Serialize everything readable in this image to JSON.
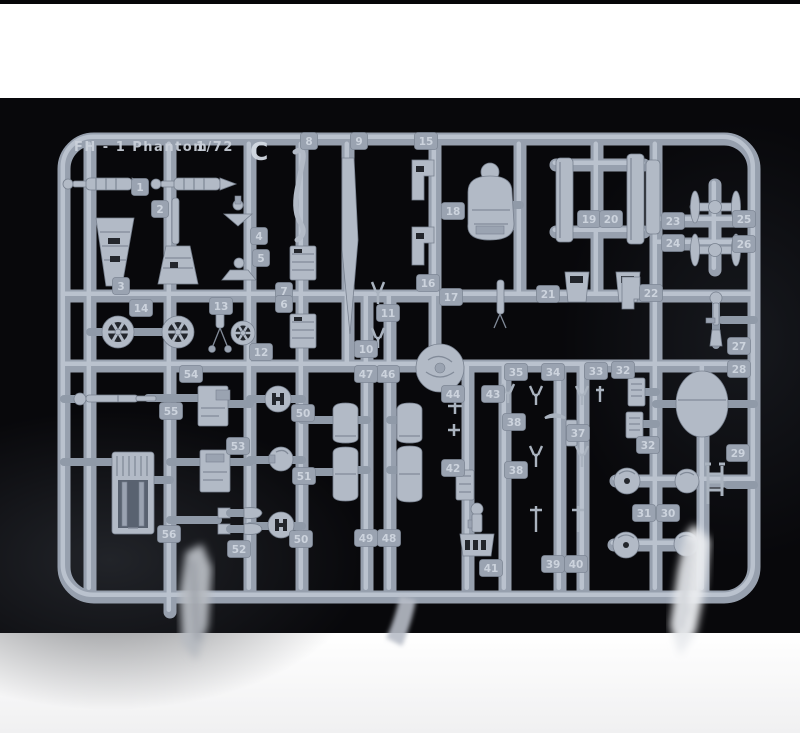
{
  "photo": {
    "backdrop_color": "#08080b",
    "surface_top_color": "#fbfbfb",
    "surface_bottom_color": "#f4f4f5",
    "plastic_color": "#b2bac6",
    "plastic_shadow": "#78818f",
    "plastic_highlight": "#c3cbd6"
  },
  "sprue": {
    "title": "FH - 1 Phantom",
    "scale": "1/72",
    "letter": "C"
  },
  "part_tags": [
    {
      "label": "1",
      "x": 140,
      "y": 187
    },
    {
      "label": "2",
      "x": 160,
      "y": 209
    },
    {
      "label": "3",
      "x": 121,
      "y": 286
    },
    {
      "label": "4",
      "x": 259,
      "y": 236
    },
    {
      "label": "5",
      "x": 261,
      "y": 258
    },
    {
      "label": "7",
      "x": 284,
      "y": 291
    },
    {
      "label": "6",
      "x": 284,
      "y": 304
    },
    {
      "label": "8",
      "x": 309,
      "y": 141
    },
    {
      "label": "9",
      "x": 359,
      "y": 141
    },
    {
      "label": "10",
      "x": 366,
      "y": 349
    },
    {
      "label": "11",
      "x": 388,
      "y": 313
    },
    {
      "label": "12",
      "x": 261,
      "y": 352
    },
    {
      "label": "13",
      "x": 221,
      "y": 306
    },
    {
      "label": "14",
      "x": 141,
      "y": 308
    },
    {
      "label": "15",
      "x": 426,
      "y": 141
    },
    {
      "label": "16",
      "x": 428,
      "y": 283
    },
    {
      "label": "17",
      "x": 451,
      "y": 297
    },
    {
      "label": "18",
      "x": 453,
      "y": 211
    },
    {
      "label": "19",
      "x": 589,
      "y": 219
    },
    {
      "label": "20",
      "x": 611,
      "y": 219
    },
    {
      "label": "21",
      "x": 548,
      "y": 294
    },
    {
      "label": "22",
      "x": 651,
      "y": 293
    },
    {
      "label": "23",
      "x": 673,
      "y": 221
    },
    {
      "label": "24",
      "x": 673,
      "y": 243
    },
    {
      "label": "25",
      "x": 744,
      "y": 219
    },
    {
      "label": "26",
      "x": 744,
      "y": 244
    },
    {
      "label": "27",
      "x": 739,
      "y": 346
    },
    {
      "label": "28",
      "x": 739,
      "y": 369
    },
    {
      "label": "29",
      "x": 738,
      "y": 453
    },
    {
      "label": "30",
      "x": 668,
      "y": 513
    },
    {
      "label": "31",
      "x": 644,
      "y": 513
    },
    {
      "label": "32",
      "x": 623,
      "y": 370
    },
    {
      "label": "32",
      "x": 648,
      "y": 445
    },
    {
      "label": "33",
      "x": 596,
      "y": 371
    },
    {
      "label": "34",
      "x": 553,
      "y": 372
    },
    {
      "label": "35",
      "x": 516,
      "y": 372
    },
    {
      "label": "37",
      "x": 578,
      "y": 433
    },
    {
      "label": "38",
      "x": 514,
      "y": 422
    },
    {
      "label": "38",
      "x": 516,
      "y": 470
    },
    {
      "label": "39",
      "x": 553,
      "y": 564
    },
    {
      "label": "40",
      "x": 576,
      "y": 564
    },
    {
      "label": "41",
      "x": 491,
      "y": 568
    },
    {
      "label": "42",
      "x": 453,
      "y": 468
    },
    {
      "label": "43",
      "x": 493,
      "y": 394
    },
    {
      "label": "44",
      "x": 453,
      "y": 394
    },
    {
      "label": "46",
      "x": 388,
      "y": 374
    },
    {
      "label": "47",
      "x": 366,
      "y": 374
    },
    {
      "label": "48",
      "x": 389,
      "y": 538
    },
    {
      "label": "49",
      "x": 366,
      "y": 538
    },
    {
      "label": "50",
      "x": 303,
      "y": 413
    },
    {
      "label": "50",
      "x": 301,
      "y": 539
    },
    {
      "label": "51",
      "x": 304,
      "y": 476
    },
    {
      "label": "52",
      "x": 239,
      "y": 549
    },
    {
      "label": "53",
      "x": 238,
      "y": 446
    },
    {
      "label": "54",
      "x": 191,
      "y": 374
    },
    {
      "label": "55",
      "x": 171,
      "y": 411
    },
    {
      "label": "56",
      "x": 169,
      "y": 534
    }
  ]
}
